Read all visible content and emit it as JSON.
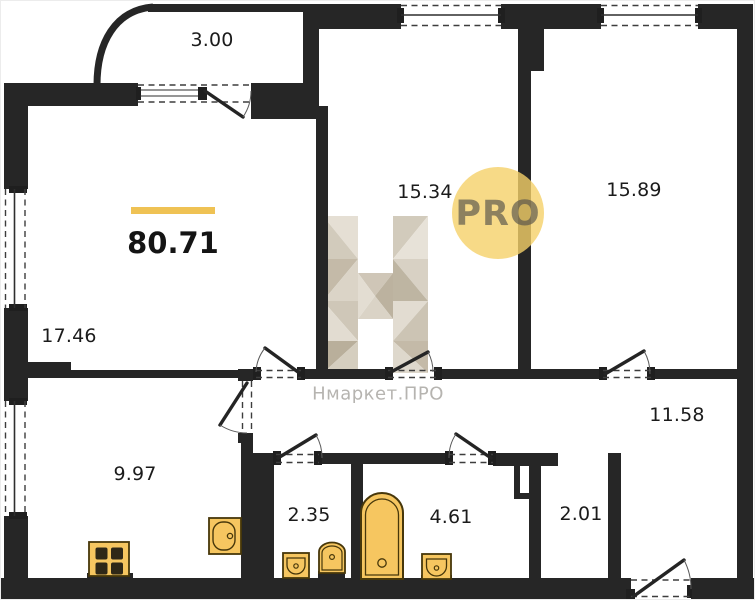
{
  "plan": {
    "title": "apartment-floor-plan",
    "total_area_label": "80.71",
    "watermark_text": "Нмаркет.ПРО",
    "watermark_badge": "PRO",
    "rooms": [
      {
        "name": "balcony",
        "area": "3.00"
      },
      {
        "name": "living-room",
        "area": "17.46"
      },
      {
        "name": "bedroom-1",
        "area": "15.34"
      },
      {
        "name": "bedroom-2",
        "area": "15.89"
      },
      {
        "name": "hallway",
        "area": "11.58"
      },
      {
        "name": "kitchen",
        "area": "9.97"
      },
      {
        "name": "wc",
        "area": "2.35"
      },
      {
        "name": "bathroom",
        "area": "4.61"
      },
      {
        "name": "storage",
        "area": "2.01"
      }
    ],
    "colors": {
      "wall": "#262626",
      "accent_yellow": "#EFC254",
      "fixture_fill": "#F6C660",
      "fixture_stroke": "#47370A",
      "badge_fill": "#F5D169",
      "watermark_gray": "#B6B4B0"
    }
  }
}
